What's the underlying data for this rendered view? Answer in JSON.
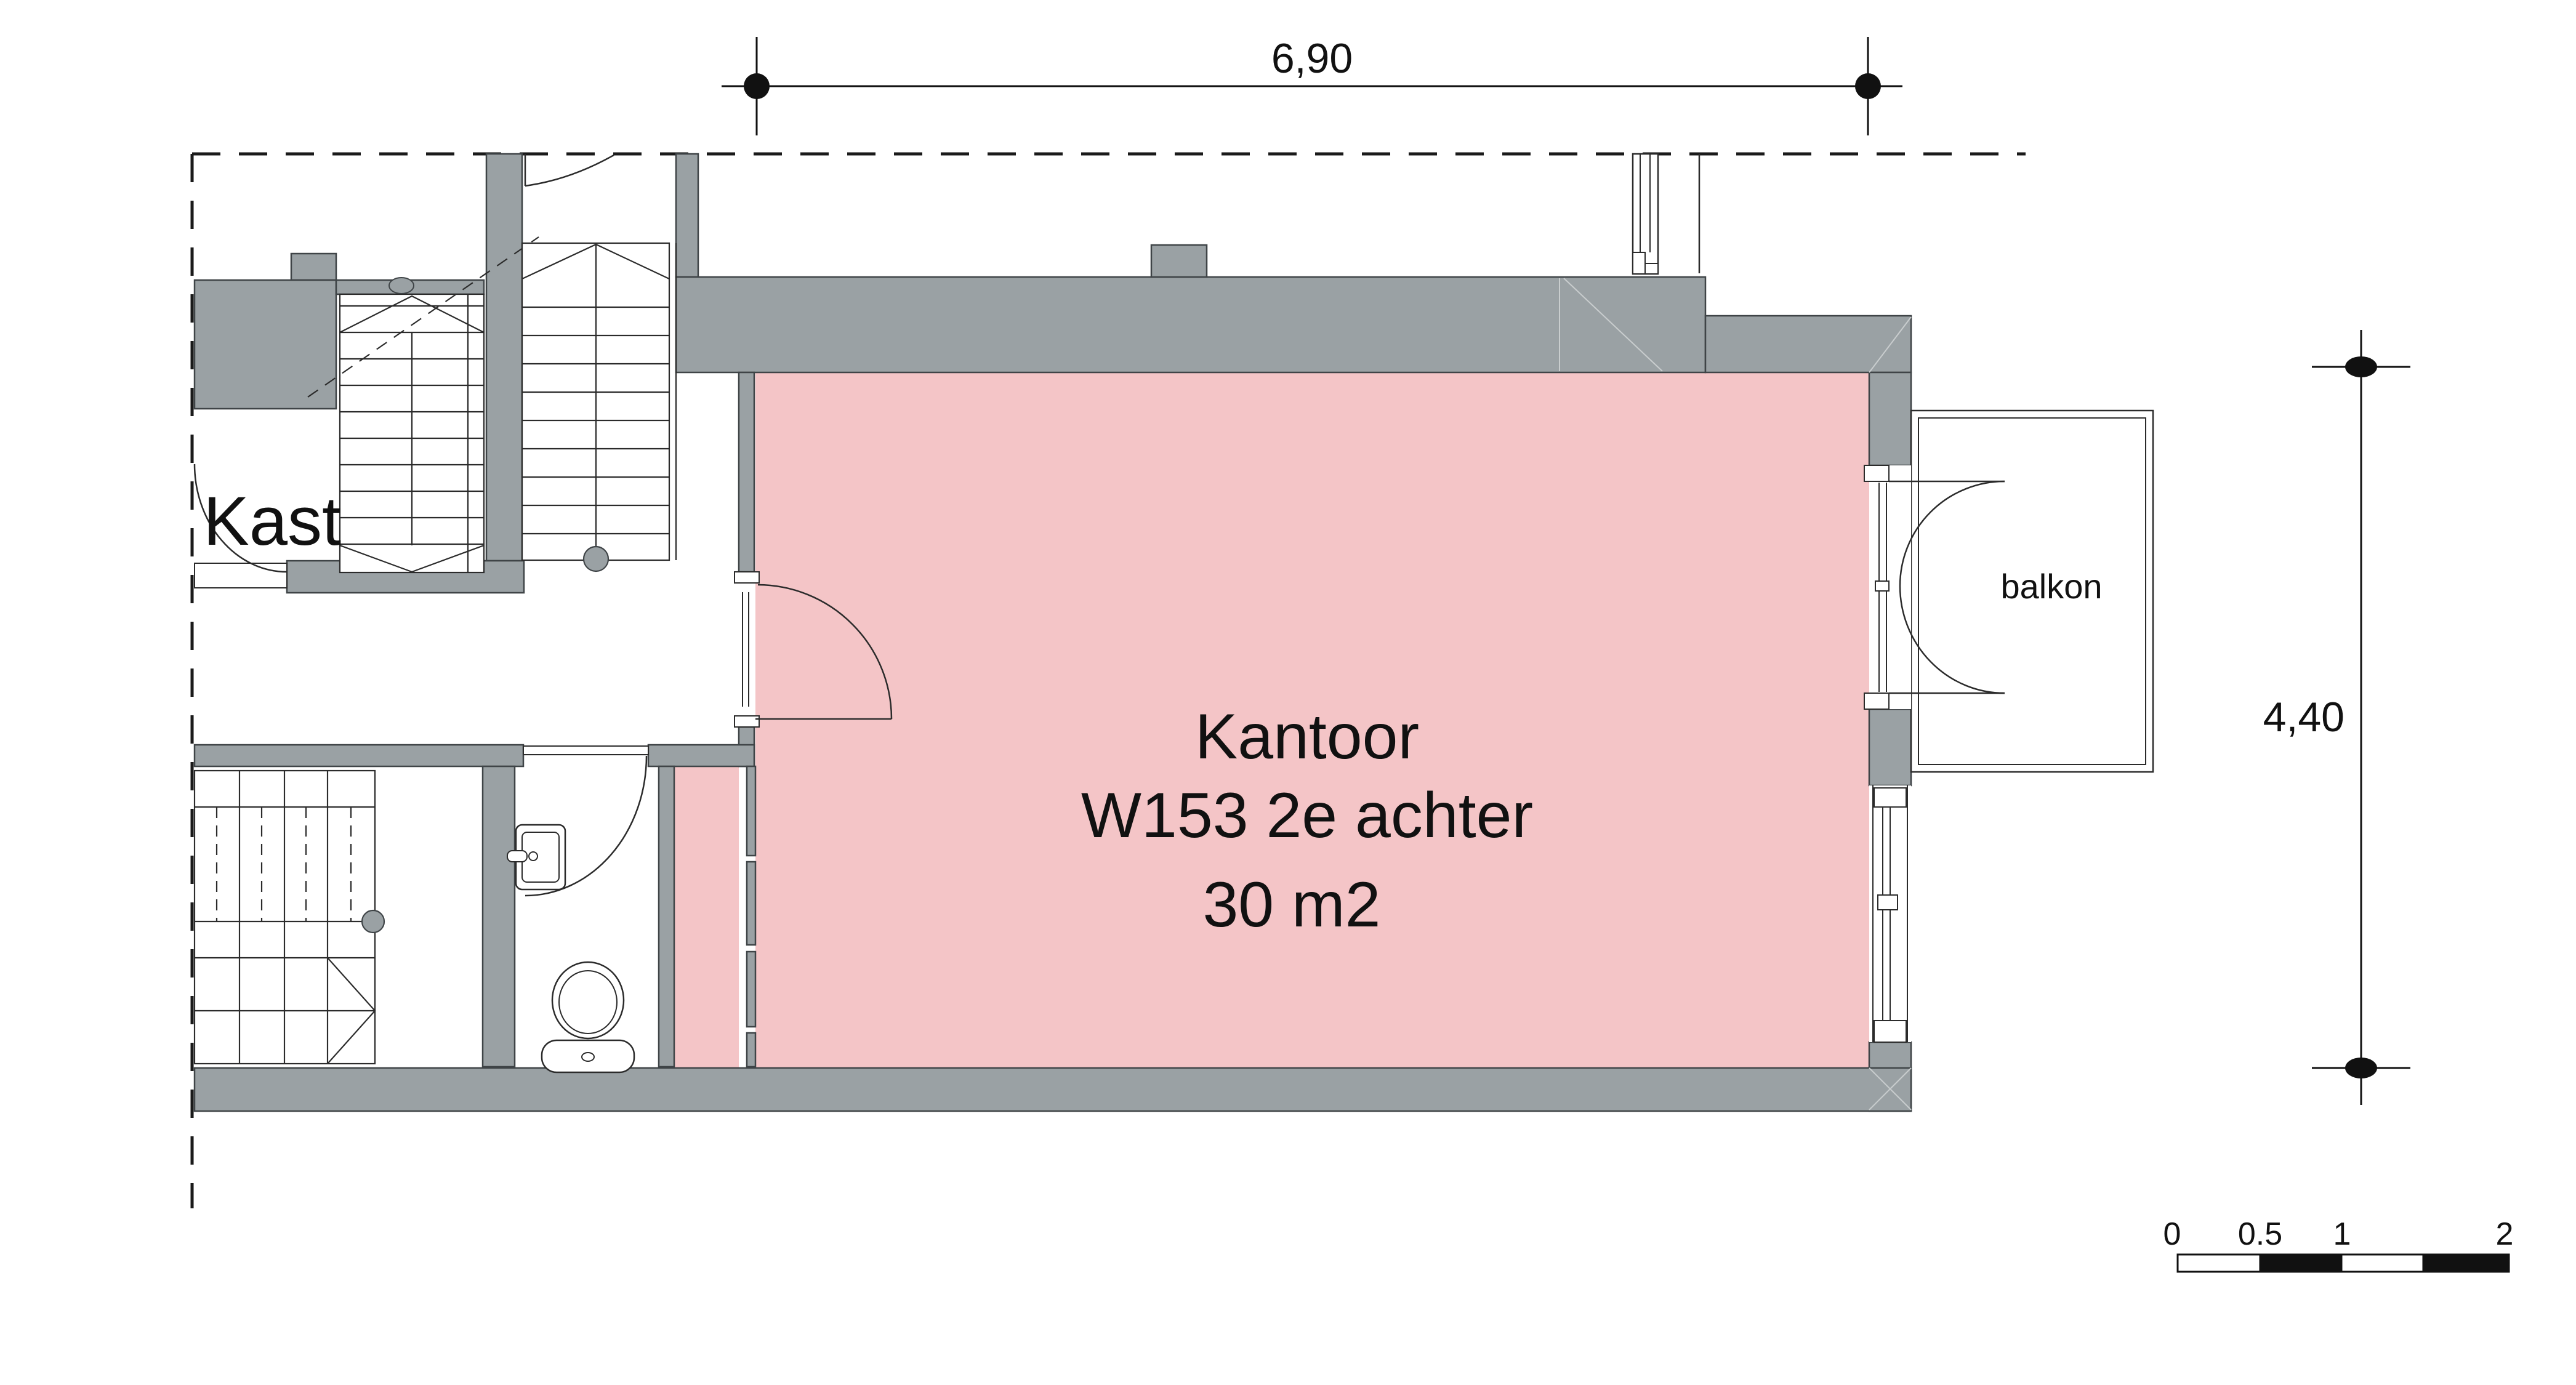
{
  "page": {
    "title": "Floor plan Kantoor W153 2e achter",
    "background": "#ffffff"
  },
  "colors": {
    "wall_fill": "#9aa1a4",
    "room_fill": "#f4c5c7",
    "line": "#2b2b2b",
    "dim_line": "#111111",
    "miter_line": "#c9cdce"
  },
  "labels": {
    "closet": "Kast",
    "balcony": "balkon",
    "office_line1": "Kantoor",
    "office_line2": "W153 2e achter",
    "office_area": "30 m2"
  },
  "dimensions": {
    "top_width": "6,90",
    "right_height": "4,40"
  },
  "scale_bar": {
    "tick0": "0",
    "tick05": "0.5",
    "tick1": "1",
    "tick2": "2"
  }
}
